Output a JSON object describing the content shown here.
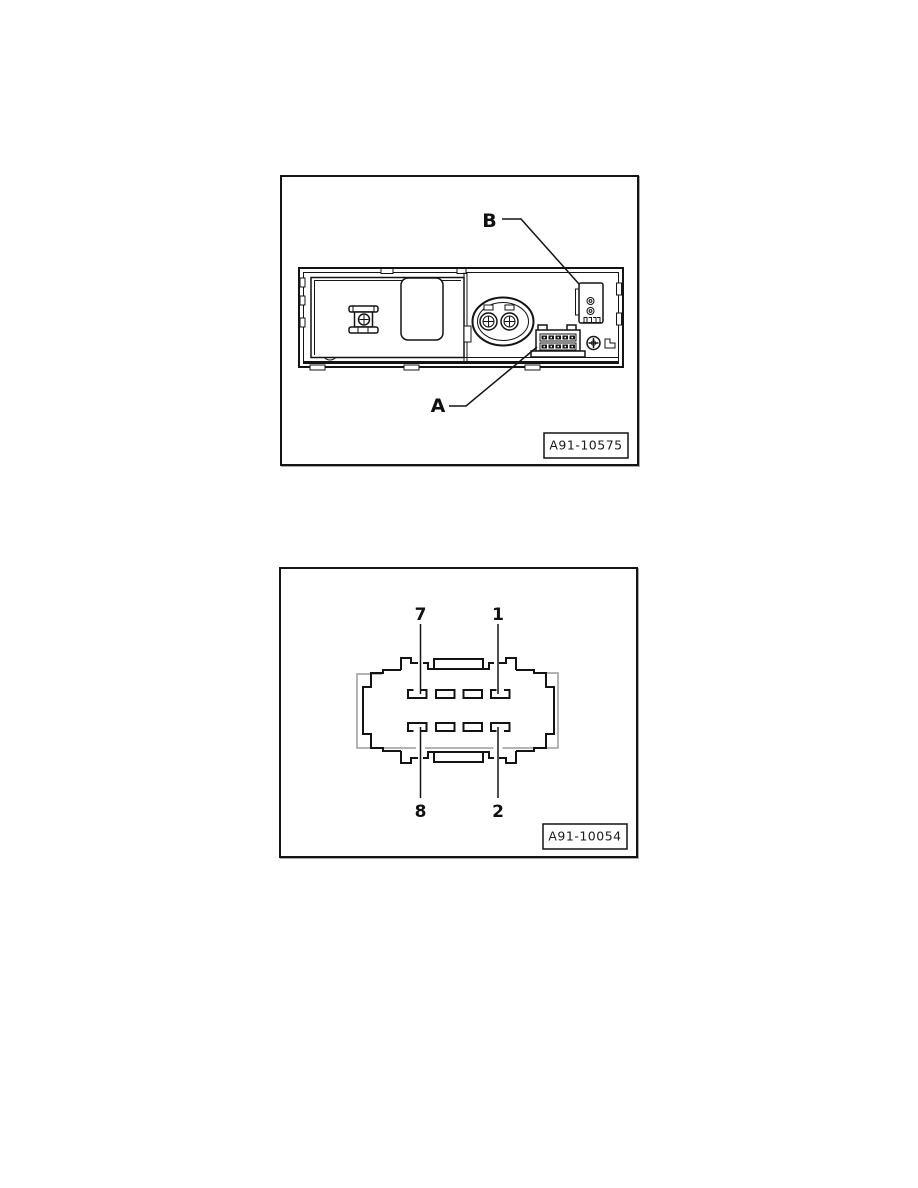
{
  "page": {
    "background": "#ffffff",
    "line_color": "#141414",
    "secondary_outline_color": "#9c9c9c"
  },
  "figure1": {
    "description": "rear view of head unit showing connectors",
    "callout_b": "B",
    "callout_a": "A",
    "figure_id": "A91-10575"
  },
  "figure2": {
    "description": "8-pin connector face view",
    "pin_labels": {
      "top_left": "7",
      "top_right": "1",
      "bottom_left": "8",
      "bottom_right": "2"
    },
    "figure_id": "A91-10054"
  }
}
